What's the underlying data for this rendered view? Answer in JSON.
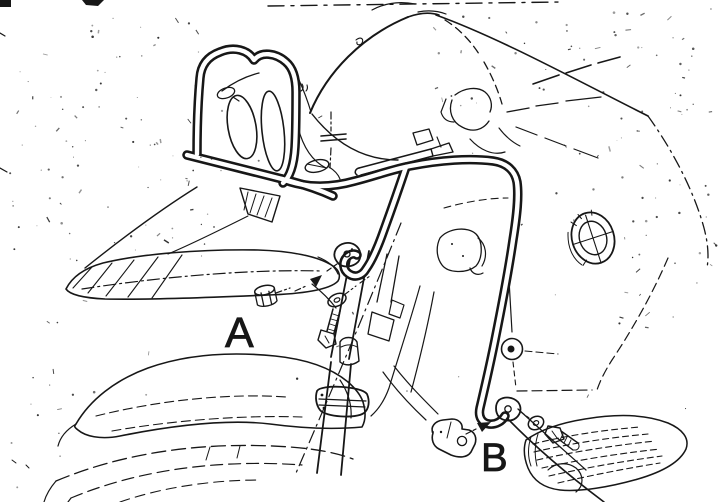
{
  "figure": {
    "background_color": "#ffffff",
    "ink_color": "#171717",
    "callouts": [
      {
        "label": "A"
      },
      {
        "label": "B"
      }
    ],
    "parts": [
      "headlight-guard-loop",
      "headlight-lenses",
      "crash-bar-tube",
      "lower-mount-strut",
      "mounting-tab-a",
      "mounting-tab-b",
      "hex-spacer-a",
      "washer-a",
      "bolt-a",
      "spacer-bolt-b",
      "washer-b",
      "bolt-b",
      "windscreen",
      "windscreen-arm",
      "front-beak",
      "front-fender",
      "front-fork",
      "fork-clamp",
      "fuel-tank",
      "bmw-roundel",
      "engine-case",
      "cylinder-fins",
      "front-tire",
      "frame-downtube"
    ]
  }
}
